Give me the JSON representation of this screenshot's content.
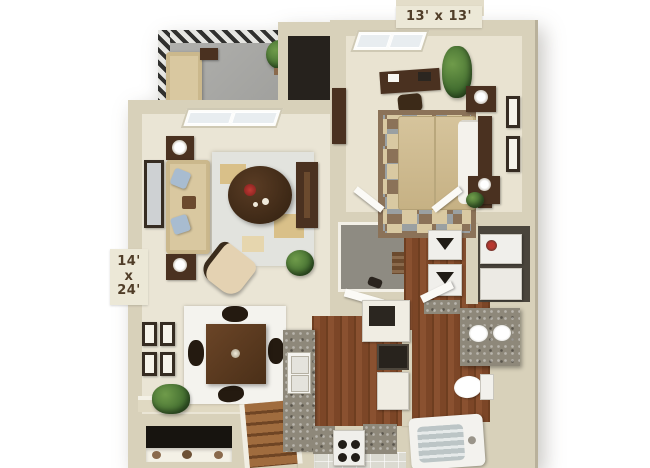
{
  "floorplan": {
    "description": "3D rendered one-bedroom apartment floor plan, top-down view",
    "labels": {
      "bedroom_dimensions": "13' x 13'",
      "living_dimensions_width": "14'",
      "living_dimensions_separator": "x",
      "living_dimensions_length": "24'"
    },
    "colors": {
      "background": "#ffffff",
      "wall": "#d8d1ba",
      "carpet": "#eae5d5",
      "bedroom_carpet": "#e9e3d1",
      "wood_floor": "#7c4a28",
      "balcony_floor": "#a6a6a3",
      "closet_floor": "#8e8b82",
      "granite_counter": "#8e887a",
      "dark_wood_furniture": "#4a3120",
      "sofa_beige": "#d9c8a0",
      "pillow_blue": "#a8bcd0",
      "bed_tan": "#cfbb92",
      "rug_brown": "#8b7258",
      "plant_green": "#4e7d3a",
      "label_bg": "#ece8d7",
      "label_text": "#503d28"
    }
  }
}
